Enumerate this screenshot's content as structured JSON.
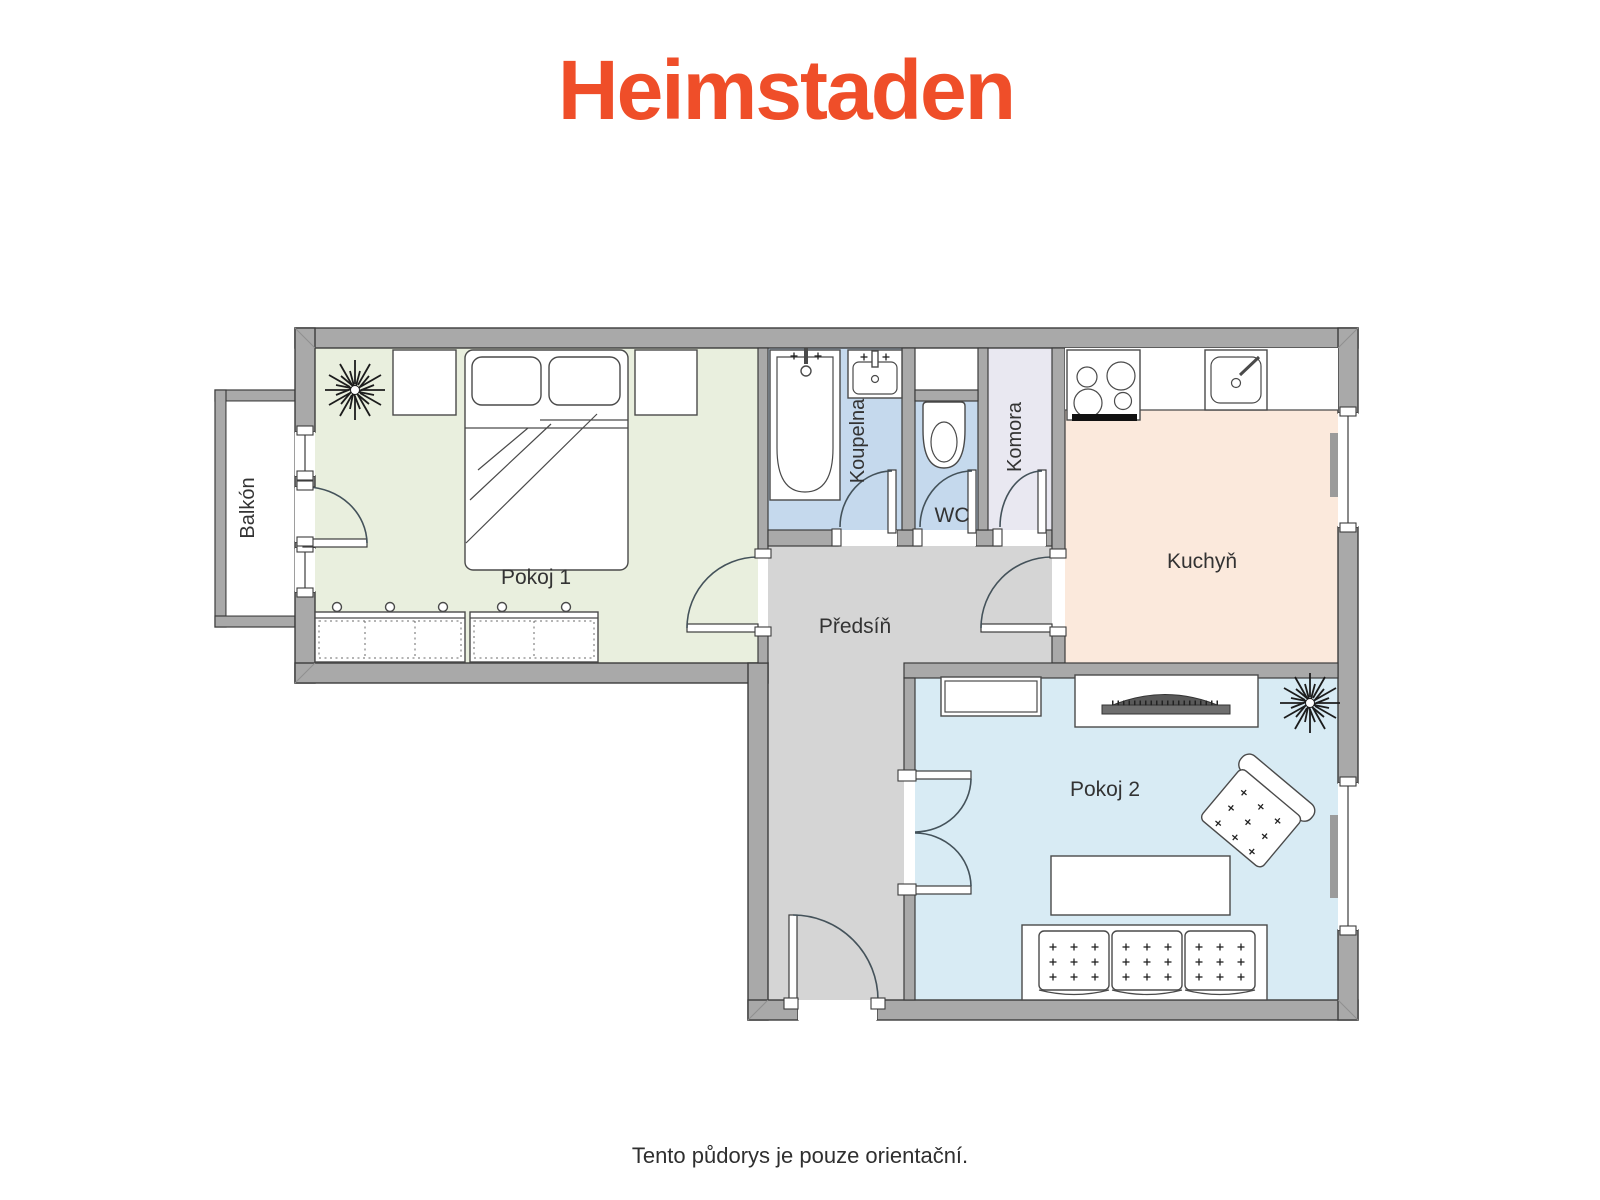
{
  "logo": {
    "text": "Heimstaden",
    "color": "#EF4E29"
  },
  "caption": {
    "text": "Tento půdorys je pouze orientační.",
    "color": "#2F2F2F"
  },
  "palette": {
    "wall_fill": "#A9A9A9",
    "wall_stroke": "#3C3C3C",
    "hall_gray": "#D5D5D5",
    "radiator_gray": "#9B9B9B",
    "tv_dark": "#595959"
  },
  "rooms": {
    "balkon": {
      "label": "Balkón",
      "fill": "#FFFFFF"
    },
    "pokoj1": {
      "label": "Pokoj 1",
      "fill": "#E9EFDE"
    },
    "koupelna": {
      "label": "Koupelna",
      "fill": "#C5D9ED"
    },
    "wc": {
      "label": "WC",
      "fill": "#C5D9ED"
    },
    "komora": {
      "label": "Komora",
      "fill": "#E9E8F1"
    },
    "kuchyn": {
      "label": "Kuchyň",
      "fill": "#FBE9DC"
    },
    "predsin": {
      "label": "Předsíň",
      "fill": "#D5D5D5"
    },
    "pokoj2": {
      "label": "Pokoj 2",
      "fill": "#D8EBF4"
    }
  }
}
